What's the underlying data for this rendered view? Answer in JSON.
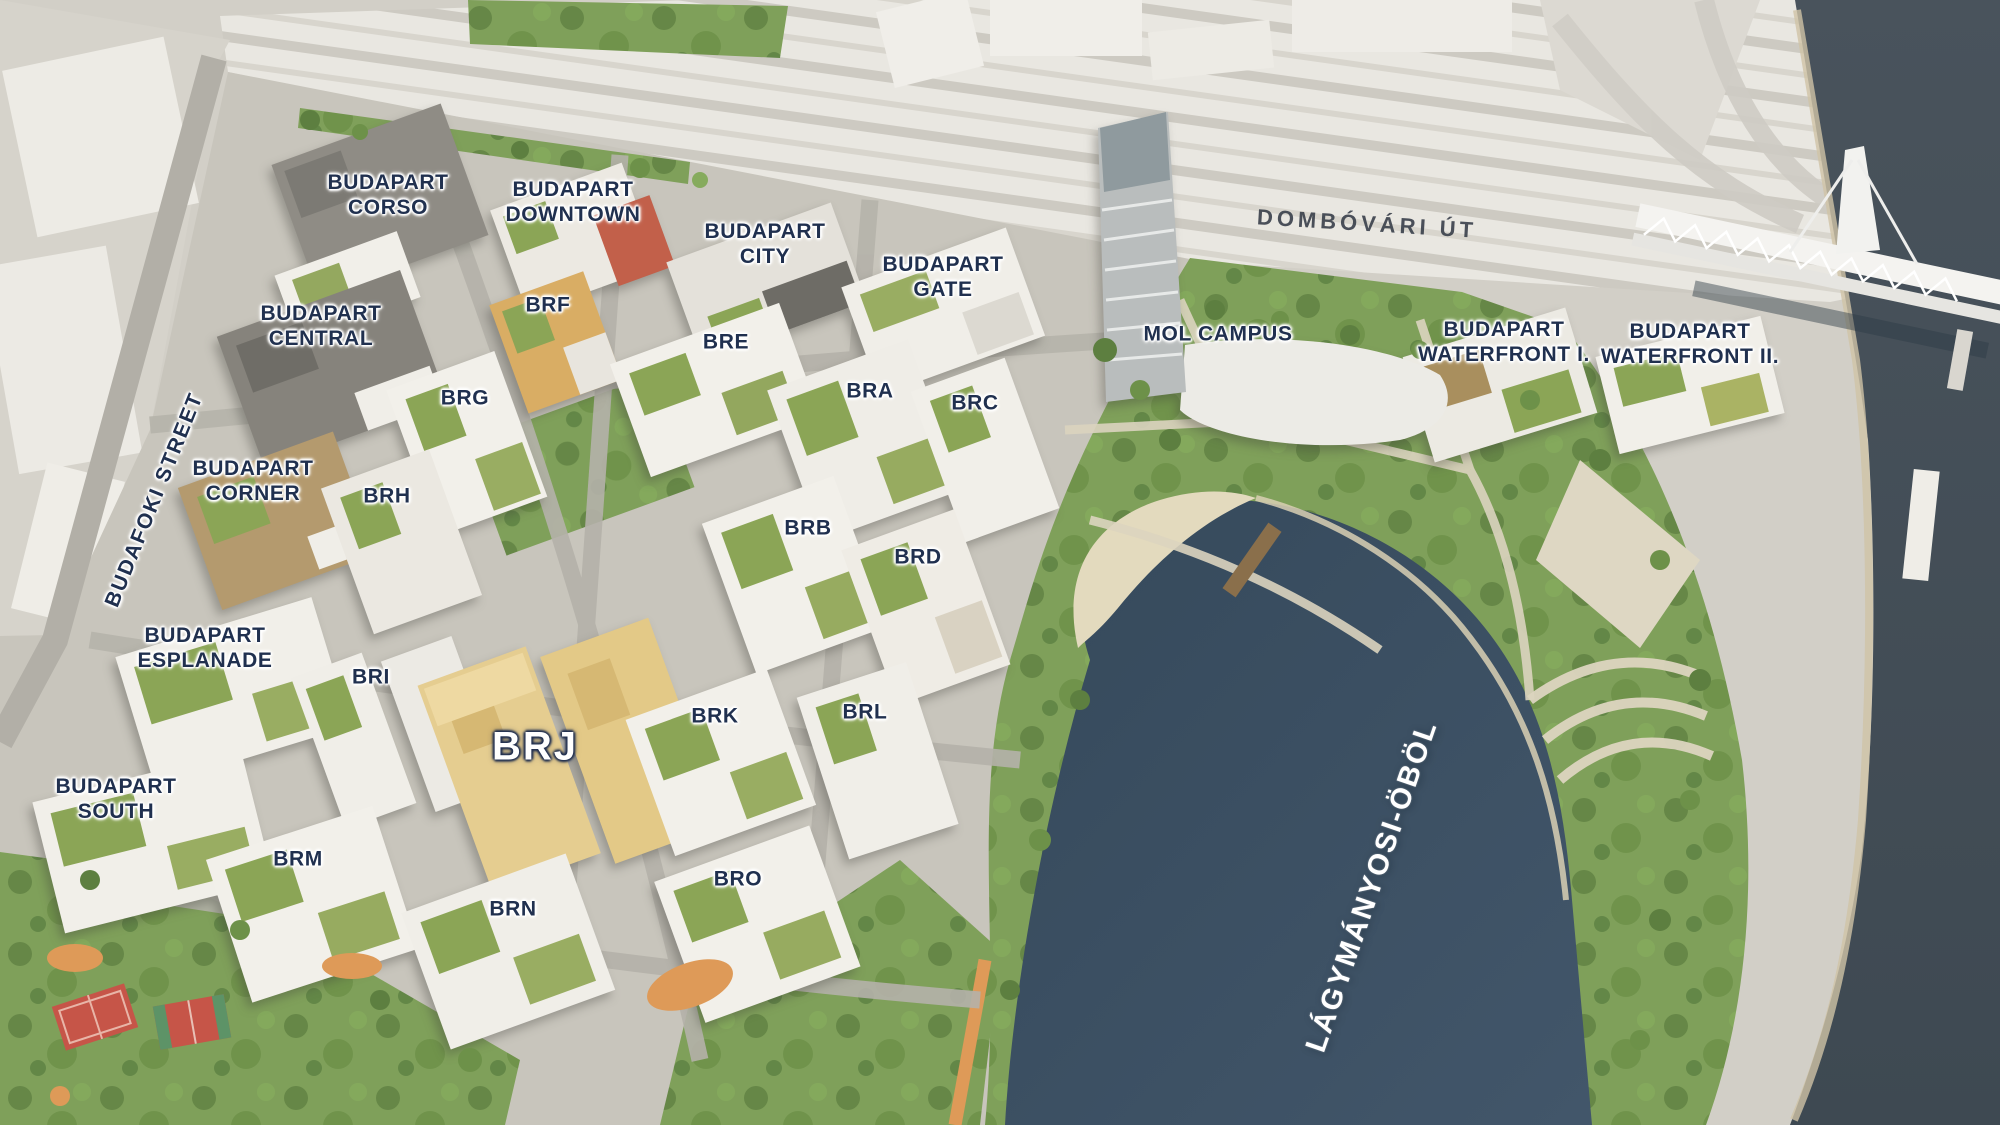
{
  "labels": {
    "corso": "BUDAPART\nCORSO",
    "downtown": "BUDAPART\nDOWNTOWN",
    "city": "BUDAPART\nCITY",
    "gate": "BUDAPART\nGATE",
    "central": "BUDAPART\nCENTRAL",
    "corner": "BUDAPART\nCORNER",
    "esplanade": "BUDAPART\nESPLANADE",
    "south": "BUDAPART\nSOUTH",
    "waterfront1": "BUDAPART\nWATERFRONT I.",
    "waterfront2": "BUDAPART\nWATERFRONT II.",
    "mol_campus": "MOL CAMPUS",
    "bra": "BRA",
    "brb": "BRB",
    "brc": "BRC",
    "brd": "BRD",
    "bre": "BRE",
    "brf": "BRF",
    "brg": "BRG",
    "brh": "BRH",
    "bri": "BRI",
    "brj": "BRJ",
    "brk": "BRK",
    "brl": "BRL",
    "brm": "BRM",
    "brn": "BRN",
    "bro": "BRO",
    "dombovari_ut": "DOMBÓVÁRI ÚT",
    "budafoki_street": "BUDAFOKI STREET",
    "lagymanyosi_obol": "LÁGYMÁNYOSI-ÖBÖL"
  },
  "colors": {
    "highlighted_building_brj": "#e5cd90",
    "bay_water": "#3d5164",
    "danube_water": "#454f57",
    "park_green": "#7fa05a",
    "label_navy": "#20304f",
    "label_white": "#ffffff"
  }
}
